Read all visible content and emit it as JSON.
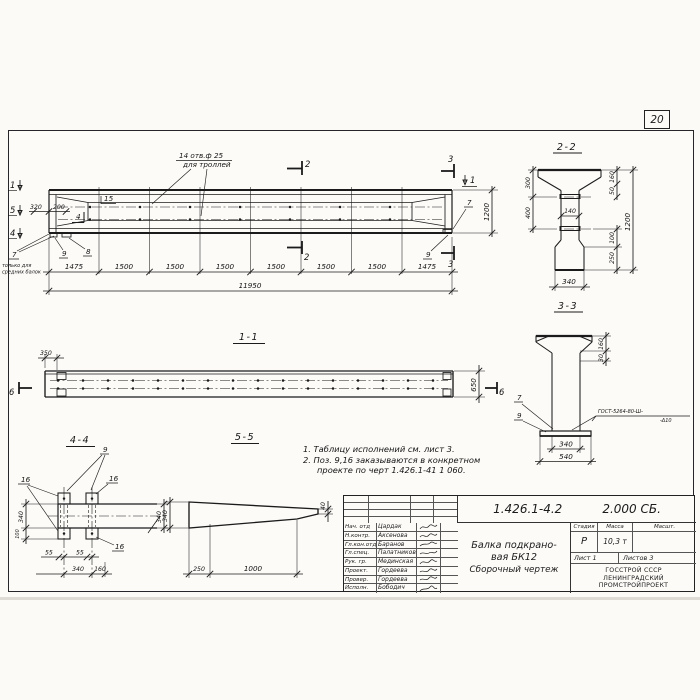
{
  "page": {
    "sheet_number": "20"
  },
  "elevation": {
    "hole_note_line1": "14 отв.ф 25",
    "hole_note_line2": "для троллей",
    "mark_1": "1",
    "mark_5": "5",
    "mark_4": "4",
    "dim_320": "320",
    "dim_200": "200",
    "pos_15": "15",
    "mark_4_inner": "4",
    "pos_7": "7",
    "pos_7_note_line1": "только для",
    "pos_7_note_line2": "средних балок",
    "pos_9": "9",
    "pos_8": "8",
    "cut_2_top": "2",
    "cut_2_bottom": "2",
    "cut_3_top": "3",
    "cut_3_bottom": "3",
    "mark_1_right": "1",
    "dim_height": "1200",
    "pos_7_right": "7",
    "pos_9_right": "9",
    "segments": [
      "1475",
      "1500",
      "1500",
      "1500",
      "1500",
      "1500",
      "1500",
      "1475"
    ],
    "dim_total": "11950"
  },
  "section_2_2": {
    "title": "2-2",
    "dim_300": "300",
    "dim_400": "400",
    "dim_140": "140",
    "dim_160": "160",
    "dim_50": "50",
    "dim_1200": "1200",
    "dim_100": "100",
    "dim_250": "250",
    "dim_340": "340"
  },
  "section_3_3": {
    "title": "3-3",
    "dim_160": "160",
    "dim_30": "30",
    "dim_340": "340",
    "dim_540": "540",
    "pos_7": "7",
    "pos_9": "9",
    "weld_note_line1": "ГОСТ-5264-80-Ш-",
    "weld_note_line2": "-Δ10"
  },
  "section_1_1": {
    "title": "1-1",
    "dim_350": "350",
    "dim_650": "650",
    "mark_6_left": "6",
    "mark_6_right": "6"
  },
  "section_4_4": {
    "title": "4-4",
    "pos_9": "9",
    "pos_16_left": "16",
    "pos_16_top": "16",
    "pos_16_bottom": "16",
    "dim_340_left": "340",
    "dim_100": "100",
    "dim_55_a": "55",
    "dim_55_b": "55",
    "dim_340_bottom": "340",
    "dim_160": "160",
    "dim_340_right": "340"
  },
  "section_5_5": {
    "title": "5-5",
    "dim_340": "340",
    "dim_40": "40",
    "dim_250": "250",
    "dim_1000": "1000"
  },
  "notes": {
    "line1": "1. Таблицу исполнений  см. лист 3.",
    "line2": "2. Поз. 9,16 заказываются в конкретном",
    "line3": "проекте по черт 1.426.1-41 1 060."
  },
  "title_block": {
    "designation": "1.426.1-4.2",
    "designation_suffix": "2.000 СБ.",
    "doc_title_line1": "Балка подкрано-",
    "doc_title_line2": "вая БК12",
    "doc_title_line3": "Сборочный чертеж",
    "col_stage": "Стадия",
    "col_mass": "Масса",
    "col_scale": "Масшт.",
    "stage": "Р",
    "mass": "10,3 т",
    "sheet": "Лист 1",
    "sheets": "Листов 3",
    "org_line1": "ГОССТРОЙ СССР",
    "org_line2": "ЛЕНИНГРАДСКИЙ",
    "org_line3": "ПРОМСТРОЙПРОЕКТ",
    "rows": [
      {
        "role": "Нач. отд",
        "name": "Цардак"
      },
      {
        "role": "Н.контр.",
        "name": "Аксенова"
      },
      {
        "role": "Гл.кон.отд",
        "name": "Баранов"
      },
      {
        "role": "Гл.спец.",
        "name": "Палатников"
      },
      {
        "role": "Рук. гр.",
        "name": "Мединская"
      },
      {
        "role": "Проект.",
        "name": "Гордеева"
      },
      {
        "role": "Провер.",
        "name": "Гордеева"
      },
      {
        "role": "Исполн.",
        "name": "Бободич"
      }
    ]
  }
}
